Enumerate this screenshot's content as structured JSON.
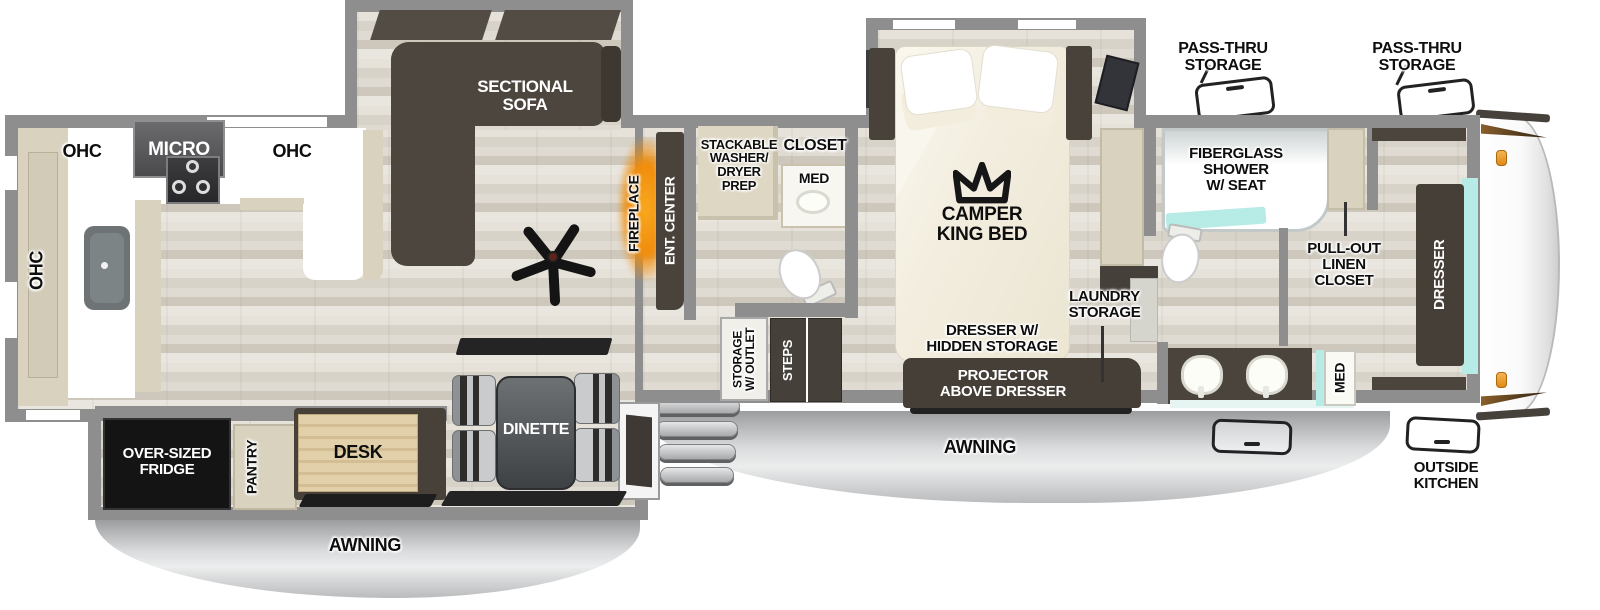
{
  "labels": {
    "ohc_left": "OHC",
    "ohc_top_left": "OHC",
    "micro": "MICRO",
    "ohc_top_right": "OHC",
    "sectional_sofa": "SECTIONAL\nSOFA",
    "fireplace": "FIREPLACE",
    "ent_center": "ENT. CENTER",
    "stackable_washer": "STACKABLE\nWASHER/\nDRYER\nPREP",
    "closet": "CLOSET",
    "med_mid": "MED",
    "storage_outlet": "STORAGE\nW/ OUTLET",
    "steps": "STEPS",
    "camper_king_bed": "CAMPER\nKING BED",
    "pass_thru_left": "PASS-THRU\nSTORAGE",
    "pass_thru_right": "PASS-THRU\nSTORAGE",
    "fiberglass_shower": "FIBERGLASS\nSHOWER\nW/ SEAT",
    "pull_out_linen": "PULL-OUT\nLINEN\nCLOSET",
    "laundry_storage": "LAUNDRY\nSTORAGE",
    "dresser_hidden": "DRESSER W/\nHIDDEN STORAGE",
    "projector": "PROJECTOR\nABOVE DRESSER",
    "dresser_front": "DRESSER",
    "med_right": "MED",
    "outside_kitchen": "OUTSIDE\nKITCHEN",
    "awning_left": "AWNING",
    "awning_right": "AWNING",
    "fridge": "OVER-SIZED\nFRIDGE",
    "pantry": "PANTRY",
    "desk": "DESK",
    "dinette": "DINETTE"
  },
  "colors": {
    "wall_gray": "#8e8e8e",
    "floor_wood": "#ddd8ce",
    "furniture_dark_brown": "#49433c",
    "cabinet_beige": "#d9d2bf",
    "counter_white": "#ffffff",
    "teal_accent": "#b7ebe6",
    "fireplace_orange": "#ef9414",
    "awning_gray": "#c9cbcd",
    "fridge_black": "#141414",
    "desk_wood": "#ddca9f",
    "marker_light_orange": "#f2a93b"
  }
}
